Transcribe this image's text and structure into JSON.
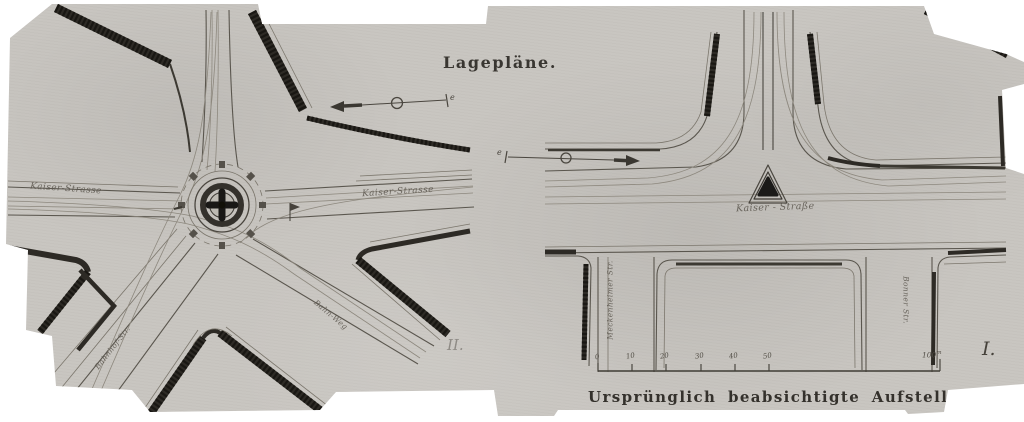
{
  "figure": {
    "title": "Lagepläne.",
    "caption": "Ursprünglich beabsichtigte Aufstellung."
  },
  "left_plan": {
    "numeral": "II.",
    "street_labels": {
      "west": "Kaiser-Strasse",
      "east": "Kaiser-Strasse",
      "southwest": "Bahnhof-Str.",
      "southeast": "Bahn-Weg"
    },
    "axis_marker_letter": "e"
  },
  "right_plan": {
    "numeral": "I.",
    "street_labels": {
      "center": "Kaiser - Straße",
      "west_vertical": "Meckenheimer Str.",
      "east_vertical": "Bonner Str."
    },
    "axis_marker_letter": "e",
    "scale_bar": {
      "ticks": [
        "0",
        "10",
        "20",
        "30",
        "40",
        "50"
      ],
      "end_label_value": "100",
      "end_label_unit": "m"
    }
  },
  "colors": {
    "paper": "#c8c5c0",
    "ink_dark": "#2d2a25",
    "ink_mid": "#5a564e",
    "ink_light": "#8d887e"
  }
}
